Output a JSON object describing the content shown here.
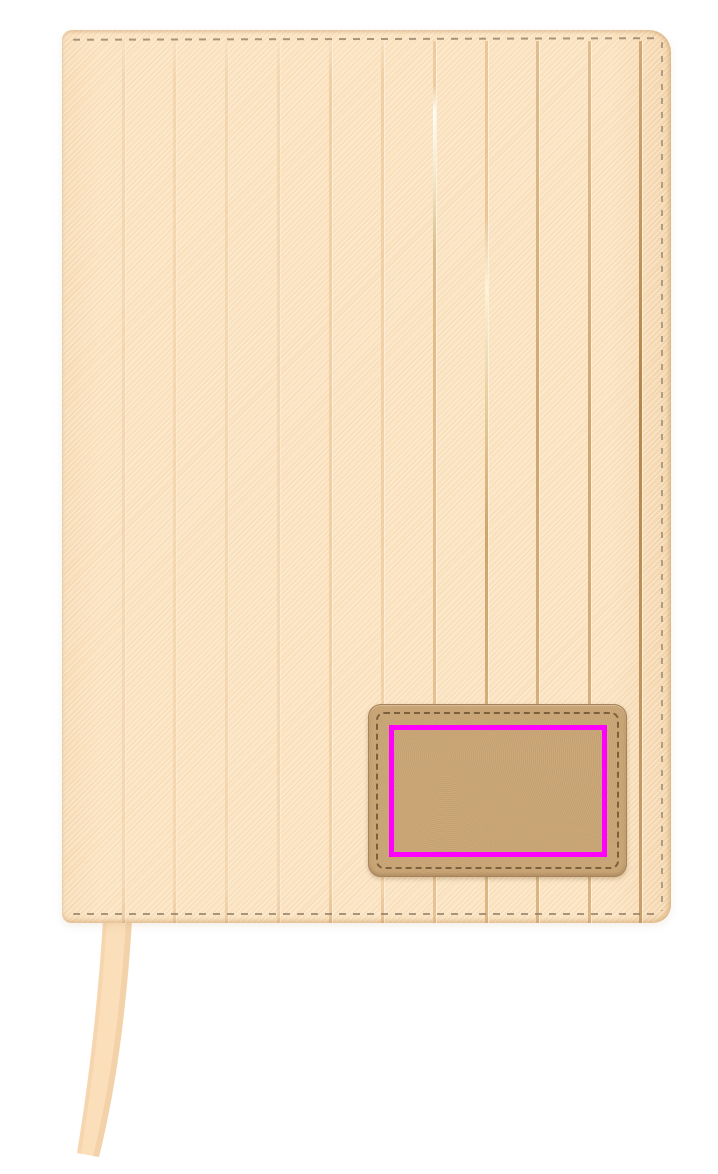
{
  "scene": {
    "subject": "blank notebook cover with pinstripe grooves, leather patch and bookmark ribbon",
    "print_area_marker": "magenta rectangle outlining the branding print zone on the patch"
  },
  "notebook": {
    "groove_count": 11,
    "has_top_stitching": true,
    "has_bottom_stitching": true,
    "has_right_stitching": true
  },
  "colors": {
    "background": "#ffffff",
    "cover_base": "#fbe3c1",
    "cover_edge": "#dfb888",
    "groove": "#dcb078",
    "groove_gold": "#b98a50",
    "groove_shine": "#fffef6",
    "stitch": "#8d7a62",
    "patch_fill": "#c9a473",
    "patch_border": "#a8845a",
    "patch_stitch": "#6f5535",
    "print_outline": "#ff00ff",
    "ribbon_fill": "#fbdfba",
    "ribbon_shade": "#eec79a"
  }
}
